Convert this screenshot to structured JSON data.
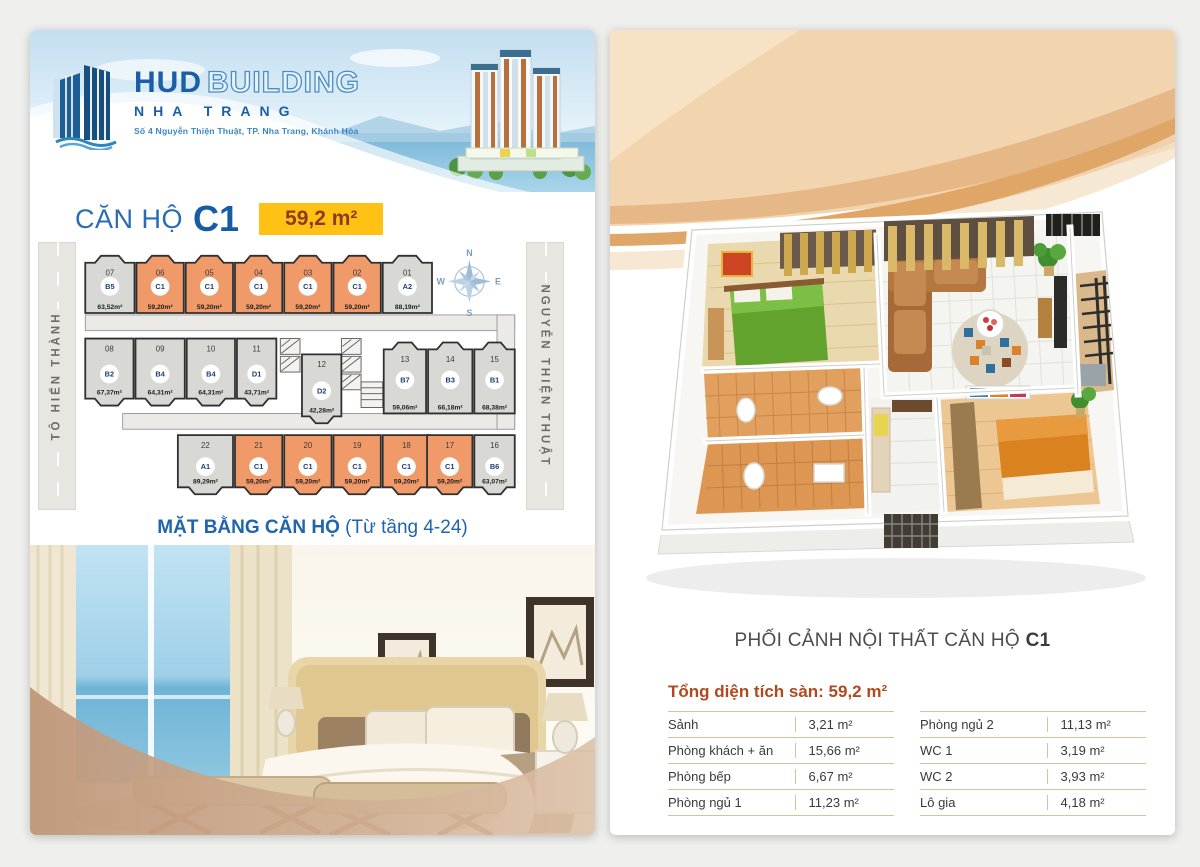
{
  "colors": {
    "accent_blue": "#1f65ae",
    "badge_yellow": "#ffc214",
    "badge_text": "#8a3c1d",
    "highlight_orange": "#f09a6a",
    "unit_gray": "#d8d8d4",
    "unit_stroke": "#2f2f2f",
    "unit_type_text": "#1c3e74",
    "table_accent": "#b04a1e",
    "table_line": "#ddc09a"
  },
  "left_page": {
    "logo": {
      "brand_main": "HUD",
      "brand_sub": "BUILDING",
      "brand_line2": "NHA TRANG",
      "address": "Số 4 Nguyễn Thiện Thuật, TP. Nha Trang, Khánh Hòa"
    },
    "title": {
      "label": "CĂN HỘ",
      "code": "C1",
      "area_badge": "59,2 m²"
    },
    "floorplan": {
      "streets": {
        "left": "TÔ HIẾN THÀNH",
        "right": "NGUYỄN THIỆN THUẬT"
      },
      "compass": {
        "n": "N",
        "e": "E",
        "s": "S",
        "w": "W"
      },
      "highlight_type": "C1",
      "rows": [
        [
          {
            "no": "07",
            "type": "B5",
            "area": "63,52m²"
          },
          {
            "no": "06",
            "type": "C1",
            "area": "59,20m²"
          },
          {
            "no": "05",
            "type": "C1",
            "area": "59,20m²"
          },
          {
            "no": "04",
            "type": "C1",
            "area": "59,20m²"
          },
          {
            "no": "03",
            "type": "C1",
            "area": "59,20m²"
          },
          {
            "no": "02",
            "type": "C1",
            "area": "59,20m²"
          },
          {
            "no": "01",
            "type": "A2",
            "area": "88,19m²"
          }
        ],
        [
          {
            "no": "08",
            "type": "B2",
            "area": "67,37m²"
          },
          {
            "no": "09",
            "type": "B4",
            "area": "64,31m²"
          },
          {
            "no": "10",
            "type": "B4",
            "area": "64,31m²"
          },
          {
            "no": "11",
            "type": "D1",
            "area": "43,71m²"
          },
          {
            "no": "12",
            "type": "D2",
            "area": "42,28m²"
          },
          {
            "no": "13",
            "type": "B7",
            "area": "59,06m²"
          },
          {
            "no": "14",
            "type": "B3",
            "area": "66,18m²"
          },
          {
            "no": "15",
            "type": "B1",
            "area": "68,38m²"
          }
        ],
        [
          {
            "no": "22",
            "type": "A1",
            "area": "89,29m²"
          },
          {
            "no": "21",
            "type": "C1",
            "area": "59,20m²"
          },
          {
            "no": "20",
            "type": "C1",
            "area": "59,20m²"
          },
          {
            "no": "19",
            "type": "C1",
            "area": "59,20m²"
          },
          {
            "no": "18",
            "type": "C1",
            "area": "59,20m²"
          },
          {
            "no": "17",
            "type": "C1",
            "area": "59,20m²"
          },
          {
            "no": "16",
            "type": "B6",
            "area": "63,07m²"
          }
        ]
      ]
    },
    "caption": {
      "bold": "MẶT BẰNG CĂN HỘ",
      "normal": "(Từ tầng 4-24)"
    }
  },
  "right_page": {
    "caption": {
      "text": "PHỐI CẢNH NỘI THẤT CĂN HỘ",
      "code": "C1"
    },
    "area_table": {
      "title": "Tổng diện tích sàn: 59,2 m²",
      "columns": [
        [
          {
            "label": "Sảnh",
            "value": "3,21 m²"
          },
          {
            "label": "Phòng khách + ăn",
            "value": "15,66 m²"
          },
          {
            "label": "Phòng bếp",
            "value": "6,67 m²"
          },
          {
            "label": "Phòng ngủ 1",
            "value": "11,23 m²"
          }
        ],
        [
          {
            "label": "Phòng ngủ 2",
            "value": "11,13 m²"
          },
          {
            "label": "WC 1",
            "value": "3,19 m²"
          },
          {
            "label": "WC 2",
            "value": "3,93 m²"
          },
          {
            "label": "Lô gia",
            "value": "4,18 m²"
          }
        ]
      ]
    }
  }
}
